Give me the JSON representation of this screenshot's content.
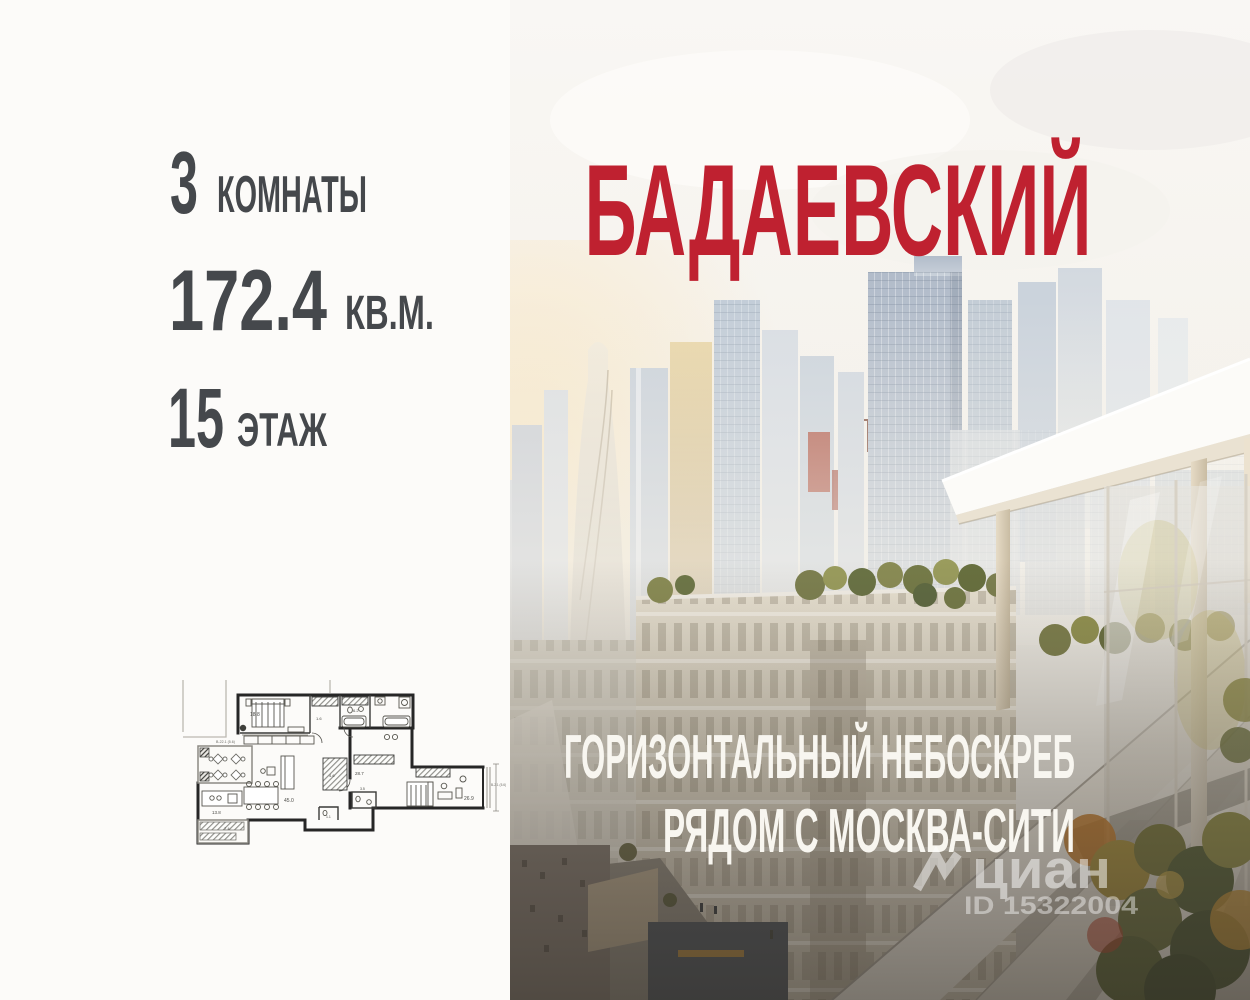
{
  "stats": {
    "rooms": {
      "value": "3",
      "label": "КОМНАТЫ"
    },
    "area": {
      "value": "172.4",
      "label": "КВ.М."
    },
    "floor": {
      "value": "15",
      "label": "ЭТАЖ"
    }
  },
  "hero": {
    "title": "БАДАЕВСКИЙ",
    "tagline_line1": "ГОРИЗОНТАЛЬНЫЙ НЕБОСКРЕБ",
    "tagline_line2": "РЯДОМ С МОСКВА-СИТИ"
  },
  "watermark": {
    "brand": "циан",
    "listing_id": "ID 15322004"
  },
  "floorplan": {
    "labels": [
      "18.8",
      "1.6",
      "6.2",
      "4.6",
      "28.7",
      "45.0",
      "13.8",
      "1.1",
      "3.5",
      "26.9",
      "7.4",
      "В-22.1 (5.6)",
      "В-2.1 (5.6)"
    ]
  },
  "colors": {
    "accent_red": "#bf2130",
    "stats_text": "#45484c",
    "tagline": "#f8f6f0"
  }
}
